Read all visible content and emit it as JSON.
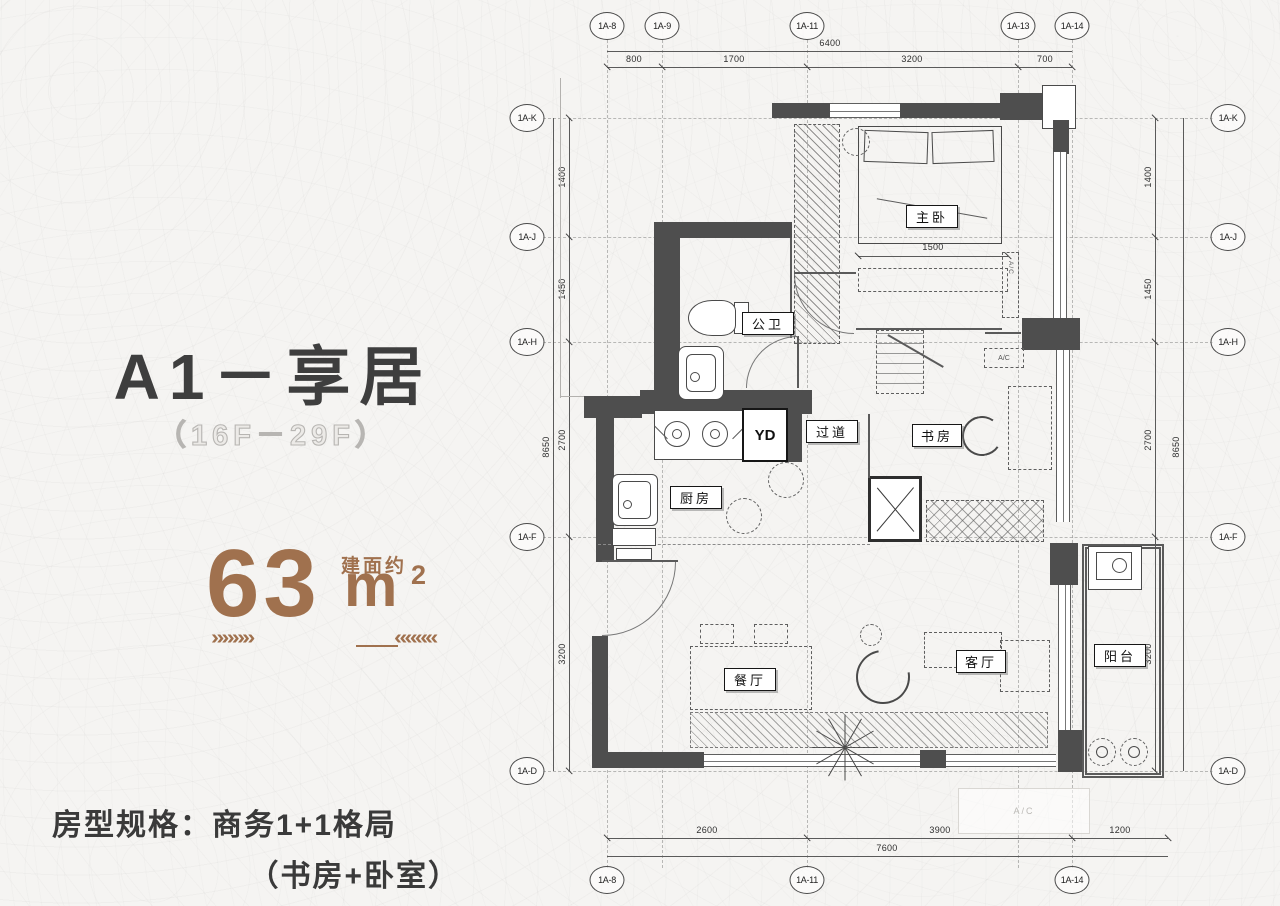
{
  "info_panel": {
    "title": "A1－享居",
    "floor_range": "（16F－29F）",
    "area_value": "63",
    "area_unit": "m",
    "area_sup": "2",
    "area_prefix": "建面约",
    "deco_left": "»»»»",
    "deco_right": "««««",
    "spec_line1": "房型规格：商务1+1格局",
    "spec_line2": "（书房+卧室）"
  },
  "plan": {
    "axis_top": [
      "1A-8",
      "1A-9",
      "1A-11",
      "1A-13",
      "1A-14"
    ],
    "axis_left": [
      "1A-K",
      "1A-J",
      "1A-H",
      "1A-F",
      "1A-D"
    ],
    "axis_right": [
      "1A-K",
      "1A-J",
      "1A-H",
      "1A-F",
      "1A-D"
    ],
    "axis_bottom": [
      "1A-8",
      "1A-11",
      "1A-14"
    ],
    "dims_top": {
      "overall": "6400",
      "seg1": "800",
      "seg2": "1700",
      "seg3": "3200",
      "seg4": "700"
    },
    "dims_side": {
      "overall": "8650",
      "seg1": "1400",
      "seg2": "1450",
      "seg3": "2700",
      "seg4": "3200"
    },
    "dims_bottom": {
      "overall": "7600",
      "seg1": "2600",
      "seg2": "3900",
      "seg3": "1200"
    },
    "dim_bedroom": "1500",
    "rooms": {
      "master_bedroom": "主卧",
      "bathroom": "公卫",
      "kitchen": "厨房",
      "yd": "YD",
      "corridor": "过道",
      "study": "书房",
      "dining": "餐厅",
      "living": "客厅",
      "balcony": "阳台"
    },
    "ac_label": "A/C"
  },
  "colors": {
    "accent_brown": "#a0714e",
    "title_gray": "#3e3e3e",
    "wall_gray": "#4e4e4e",
    "outline_gray": "#b7b5b2"
  }
}
